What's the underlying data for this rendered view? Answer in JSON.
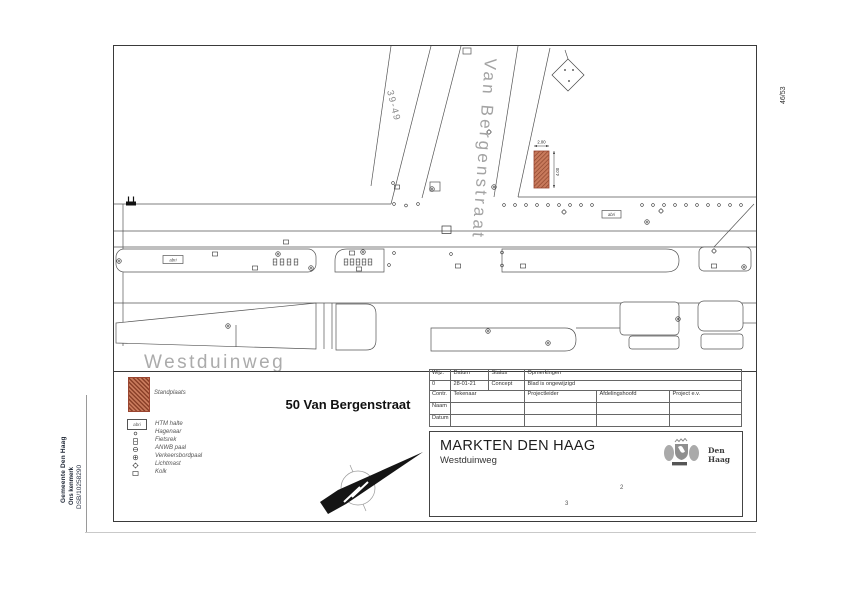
{
  "page": {
    "number": "46/53",
    "margin": {
      "gemeente": "Gemeente Den Haag",
      "kenmerk_label": "Ons kenmerk",
      "kenmerk_value": "DSB/10258290"
    }
  },
  "map": {
    "street_main": "Van Bergenstraat",
    "street_cross": "Westduinweg",
    "parcel_label": "39-49",
    "abri_label": "abri",
    "standplaats": {
      "width_label": "2.00",
      "height_label": "4.00"
    }
  },
  "legend": {
    "items": [
      {
        "symbol": "standplaats-swatch",
        "label": "Standplaats"
      },
      {
        "symbol": "abri-box",
        "label": "HTM halte"
      },
      {
        "symbol": "hagenaar",
        "label": "Hagenaar"
      },
      {
        "symbol": "fietsrek",
        "label": "Fietsrek"
      },
      {
        "symbol": "anwb-paal",
        "label": "ANWB paal"
      },
      {
        "symbol": "verkeersbordpaal",
        "label": "Verkeersbordpaal"
      },
      {
        "symbol": "lichtmast",
        "label": "Lichtmast"
      },
      {
        "symbol": "kolk",
        "label": "Kolk"
      }
    ]
  },
  "drawing_title": "50 Van Bergenstraat",
  "revision_table": {
    "headers": {
      "wijz": "Wijz.",
      "datum": "Datum",
      "status": "Status",
      "opmerkingen": "Opmerkingen"
    },
    "row": {
      "wijz": "0",
      "datum": "28-01-21",
      "status": "Concept",
      "opmerkingen": "Blad is ongewijzigd"
    },
    "roles": {
      "contr": "Contr.",
      "tekenaar": "Tekenaar",
      "projectleider": "Projectleider",
      "afdelingshoofd": "Afdelingshoofd",
      "project_ev": "Project e.v."
    },
    "rows": {
      "naam": "Naam",
      "datum": "Datum"
    }
  },
  "title_block": {
    "title": "MARKTEN DEN HAAG",
    "subtitle": "Westduinweg",
    "logo_text": "Den Haag",
    "grid_2": "2",
    "grid_3": "3"
  },
  "colors": {
    "standplaats": "#b2553c",
    "line": "#555555",
    "street_text": "#a3a3a3"
  }
}
